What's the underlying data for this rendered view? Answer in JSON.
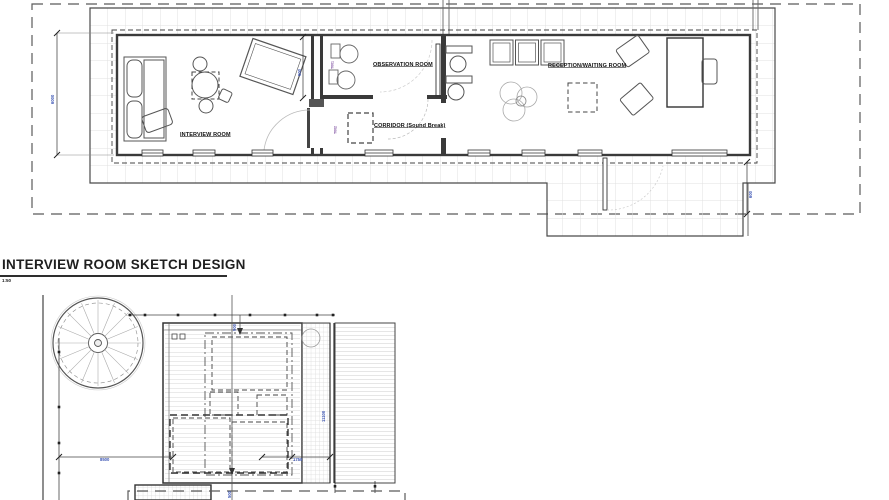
{
  "drawing": {
    "title": "INTERVIEW ROOM SKETCH DESIGN",
    "scale": "1:50"
  },
  "floor_plan": {
    "rooms": [
      {
        "label": "INTERVIEW ROOM"
      },
      {
        "label": "OBSERVATION ROOM"
      },
      {
        "label": "CORRIDOR (Sound Break)"
      },
      {
        "label": "RECEPTION/WAITING ROOM"
      }
    ],
    "dimensions": {
      "room_height": "6000",
      "sound_break": "900",
      "deck_edge": "600",
      "tag_observation": "T001",
      "tag_corridor": "T002"
    }
  },
  "site_plan": {
    "dimensions": {
      "building_width": "8500",
      "walkway_width": "1750",
      "building_length": "11100",
      "roof_offset": "900",
      "deck_offset": "500"
    }
  },
  "colors": {
    "line_dark": "#3a3a3a",
    "line_grid": "#dddddd",
    "dim_text": "#3b54b4",
    "boundary": "#5a5a5a"
  }
}
